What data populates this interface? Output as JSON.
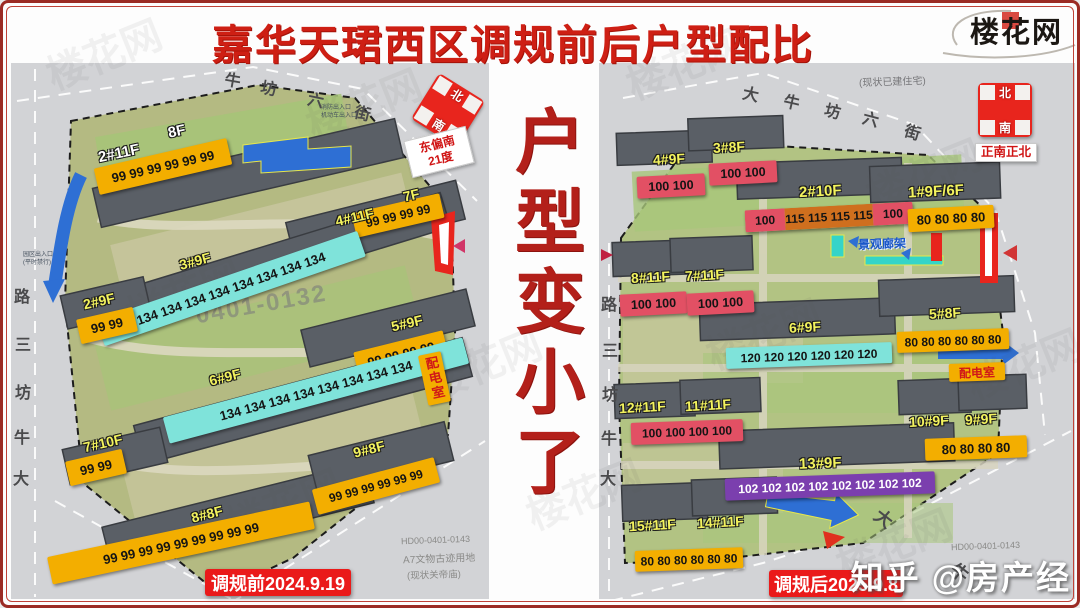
{
  "frame": {
    "title": "嘉华天珺西区调规前后户型配比",
    "logo": "楼花网",
    "center_text": "户型变小了",
    "watermark": "知乎 @房产经",
    "ghost": "楼花网"
  },
  "left": {
    "date_label": "调规前2024.9.19",
    "compass": {
      "n": "北",
      "s": "南",
      "note1": "东偏南",
      "note2": "21度"
    },
    "street_top": [
      "牛",
      "坊",
      "六",
      "街"
    ],
    "street_left": [
      "路",
      "三",
      "坊",
      "牛",
      "大"
    ],
    "parcel": "0401-0132",
    "power_room": "配电室",
    "notes": {
      "code": "HD00-0401-0143",
      "landuse": "A7文物古迹用地",
      "status": "(现状关帝庙)",
      "gate1": "消防出入口",
      "gate2": "机动车出入口",
      "gate3": "园区出入口",
      "gate4": "(平时禁行)"
    },
    "buildings": [
      {
        "name": "2#11F",
        "name2": "8F",
        "values": "99 99 99 99 99 99"
      },
      {
        "name": "4#11F",
        "name2": "7F",
        "values": "99 99 99 99"
      },
      {
        "name": "3#9F",
        "values": "134 134 134 134 134 134 134 134"
      },
      {
        "name": "2#9F",
        "values": "99 99"
      },
      {
        "name": "5#9F",
        "values": "99 99 99 99"
      },
      {
        "name": "6#9F",
        "values": "134 134 134 134 134 134 134 134"
      },
      {
        "name": "7#10F",
        "values": "99 99"
      },
      {
        "name": "8#8F",
        "values": "99 99 99 99 99 99 99 99 99"
      },
      {
        "name": "9#8F",
        "values": "99 99 99 99 99 99"
      }
    ]
  },
  "right": {
    "date_label": "调规后2025.9.8",
    "compass": {
      "n": "北",
      "s": "南",
      "note": "正南正北"
    },
    "existing_note": "(现状已建住宅)",
    "street_top": [
      "大",
      "牛",
      "坊",
      "六",
      "街"
    ],
    "street_left": [
      "路",
      "三",
      "坊",
      "牛",
      "大"
    ],
    "street_corner": [
      "大",
      "牛"
    ],
    "landscape": "景观廊架",
    "power_room": "配电室",
    "code": "HD00-0401-0143",
    "buildings": [
      {
        "name": "4#9F",
        "values": "100 100"
      },
      {
        "name": "3#8F",
        "values": "100 100"
      },
      {
        "name": "2#10F",
        "v1": "100",
        "v2": "115 115 115 115",
        "v3": "100"
      },
      {
        "name": "1#9F/6F",
        "values": "80 80 80 80"
      },
      {
        "name": "8#11F",
        "values": "100 100"
      },
      {
        "name": "7#11F",
        "values": "100 100"
      },
      {
        "name": "6#9F",
        "values": "120 120 120 120 120 120"
      },
      {
        "name": "5#8F",
        "values": "80 80 80 80 80 80"
      },
      {
        "name": "12#11F",
        "name2": "11#11F",
        "values": "100 100 100 100"
      },
      {
        "name": "13#9F",
        "values": "102 102 102 102 102 102 102 102"
      },
      {
        "name": "10#9F",
        "name2": "9#9F",
        "values": "80 80 80 80"
      },
      {
        "name": "15#11F",
        "name2": "14#11F",
        "values": "80 80 80 80 80 80"
      }
    ]
  }
}
